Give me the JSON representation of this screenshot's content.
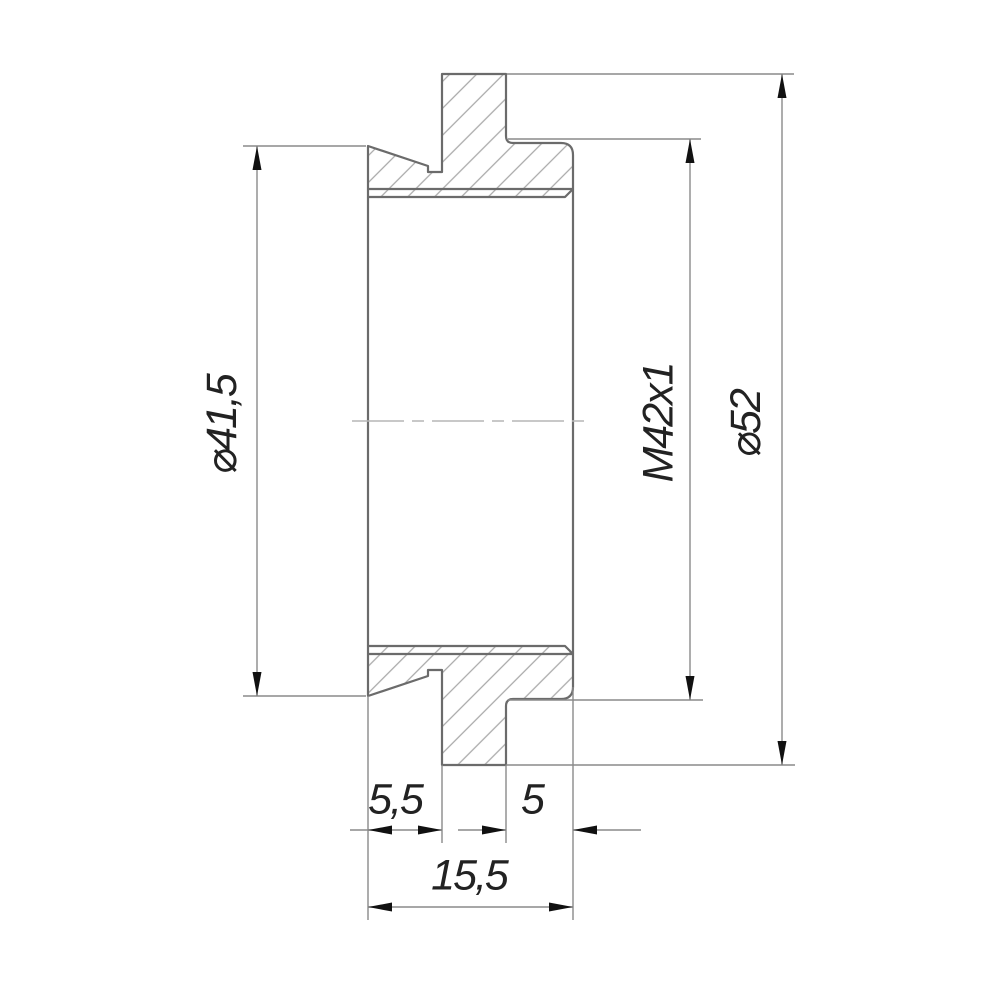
{
  "drawing": {
    "kind": "technical-drawing",
    "subject": "threaded-ring-cross-section",
    "labels": {
      "inner_left_diameter": "⌀41,5",
      "thread_spec": "M42x1",
      "outer_diameter": "⌀52",
      "left_shoulder_width": "5,5",
      "flange_step_width": "5",
      "overall_length": "15,5"
    },
    "colors": {
      "background": "#ffffff",
      "outline": "#6b6b6b",
      "thin_line": "#8a8a8a",
      "hatch": "#a8a8a8",
      "centerline": "#b5b5b5",
      "arrow": "#111111",
      "text": "#222222"
    }
  }
}
